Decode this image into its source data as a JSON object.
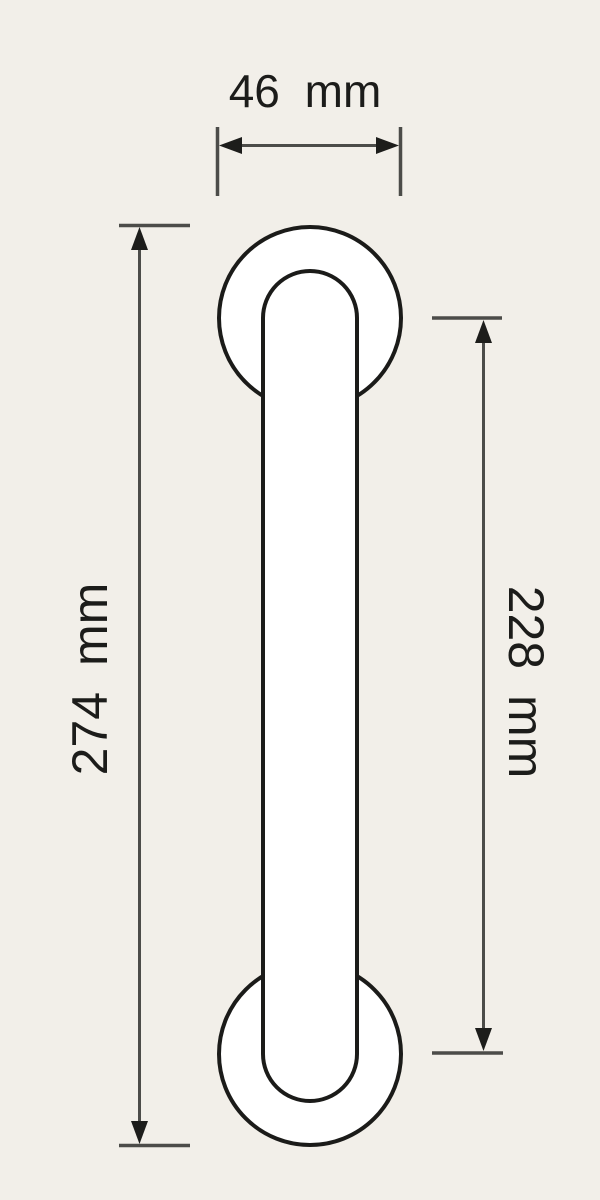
{
  "drawing": {
    "type": "technical-dimension-drawing",
    "view": "pull handle front elevation"
  },
  "colors": {
    "background": "#f2efe9",
    "part_fill": "#ffffff",
    "part_outline": "#1b1b19",
    "dimension_lines": "#4c4c49",
    "label_text": "#1c1c1a"
  },
  "dimensions": {
    "width": {
      "label": "46 mm"
    },
    "overall_length": {
      "label": "274 mm"
    },
    "fixing_centers": {
      "label": "228 mm"
    }
  }
}
